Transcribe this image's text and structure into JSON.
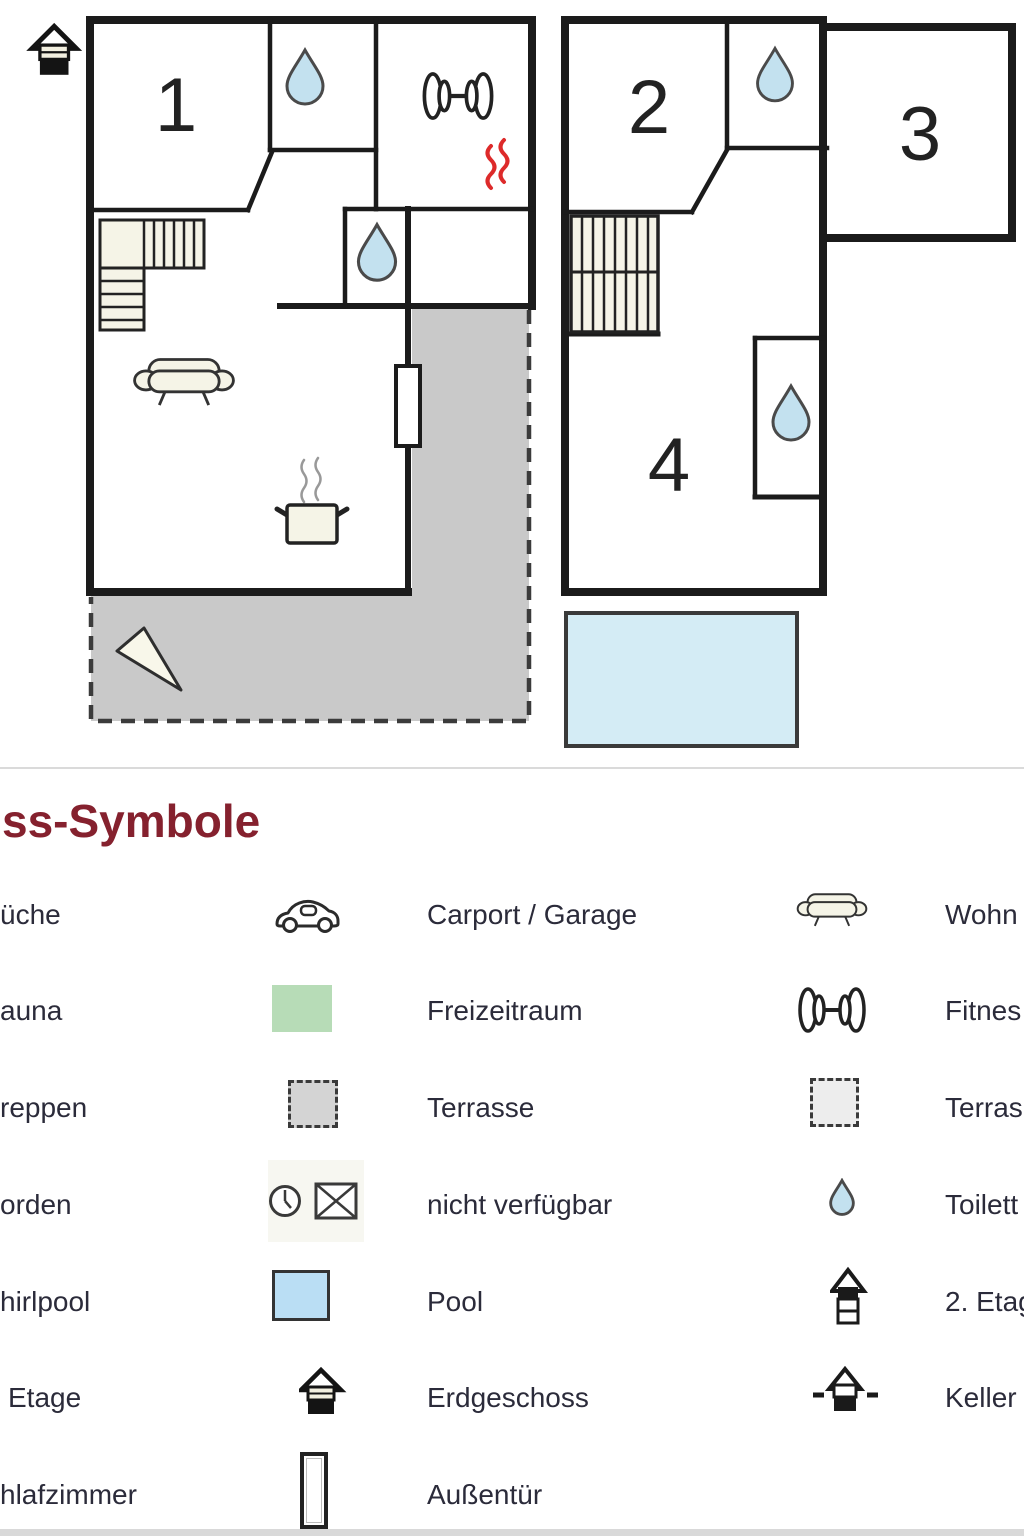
{
  "page": {
    "background": "#ffffff"
  },
  "floor_plan": {
    "left": {
      "room_numbers": {
        "room1": "1"
      }
    },
    "right": {
      "room_numbers": {
        "room2": "2",
        "room3": "3",
        "room4": "4"
      }
    },
    "colors": {
      "wall": "#1b1b1b",
      "terrace_fill": "#c9c9c9",
      "pool_fill": "#d4ecf5",
      "drop_fill": "#c3e1ef",
      "furniture_fill": "#f5f4e7",
      "sauna_mark": "#dd2a2a"
    }
  },
  "legend": {
    "heading": "ss-Symbole",
    "heading_color": "#85212e",
    "text_color": "#2b2b3a",
    "rows": [
      {
        "left_label": "üche",
        "mid_icon": "car-icon",
        "mid_label": "Carport / Garage",
        "right_icon": "sofa-icon",
        "right_label": "Wohn"
      },
      {
        "left_label": "auna",
        "mid_icon": "freizeitraum-green-square",
        "mid_label": "Freizeitraum",
        "right_icon": "dumbbell-icon",
        "right_label": "Fitnes"
      },
      {
        "left_label": "reppen",
        "mid_icon": "terrace-dashed-square",
        "mid_label": "Terrasse",
        "right_icon": "terrace-light-dashed-square",
        "right_label": "Terras"
      },
      {
        "left_label": "orden",
        "mid_icon": "clock-crossed-envelope-icon",
        "mid_label": "nicht verfügbar",
        "right_icon": "water-drop-icon",
        "right_label": "Toilett"
      },
      {
        "left_label": "hirlpool",
        "mid_icon": "pool-blue-square",
        "mid_label": "Pool",
        "right_icon": "upper-floor-house-icon",
        "right_label": "2. Etag"
      },
      {
        "left_label": "Etage",
        "mid_icon": "ground-floor-house-icon",
        "mid_label": "Erdgeschoss",
        "right_icon": "basement-house-icon",
        "right_label": "Keller"
      },
      {
        "left_label": "hlafzimmer",
        "mid_icon": "door-icon",
        "mid_label": "Außentür",
        "right_icon": "",
        "right_label": ""
      }
    ]
  }
}
